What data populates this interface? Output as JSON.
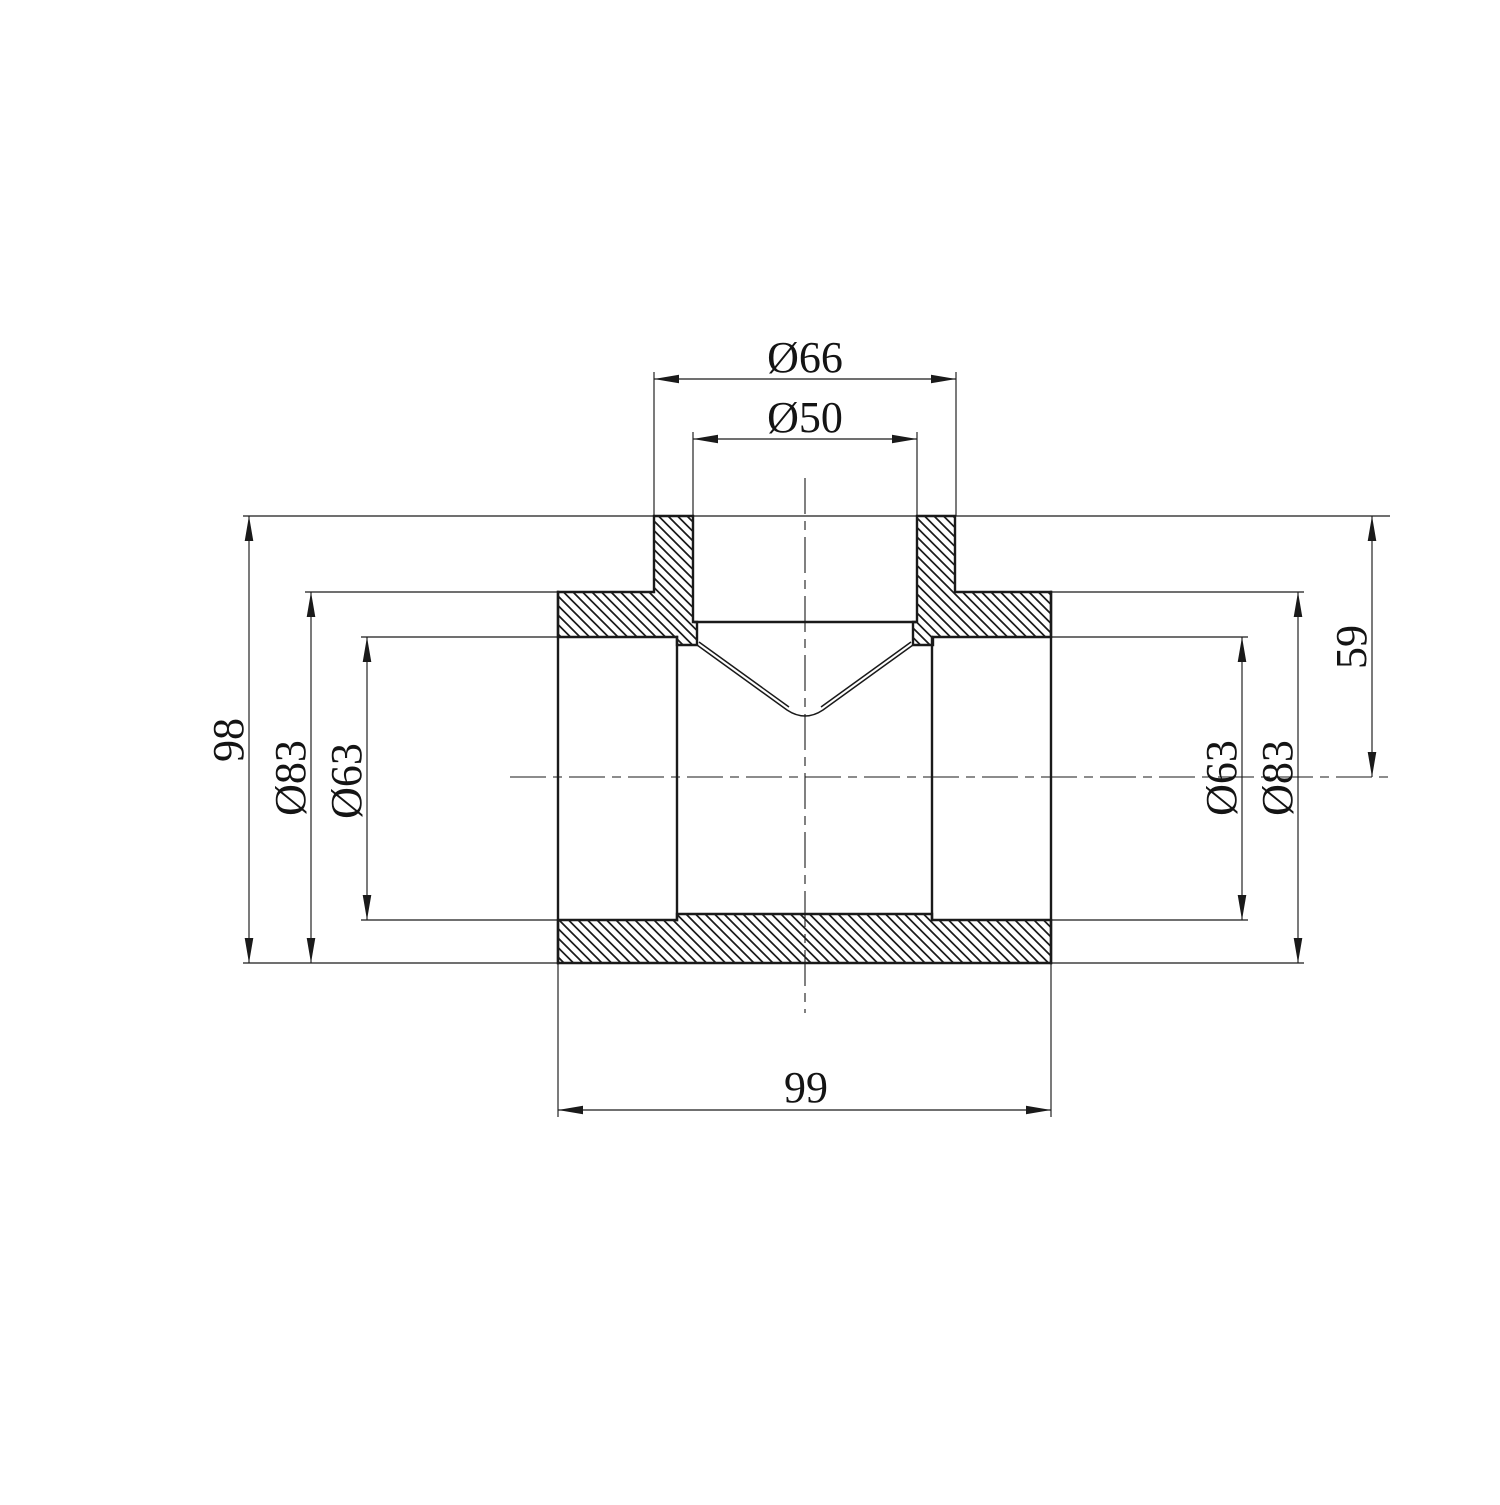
{
  "drawing": {
    "type": "technical-section-drawing",
    "subject": "pipe-tee-fitting-cross-section",
    "colors": {
      "background": "#ffffff",
      "line": "#1a1a1a",
      "text": "#141414"
    },
    "dimensions": {
      "branch_outer_diameter": "Ø66",
      "branch_bore_diameter": "Ø50",
      "overall_height": "98",
      "left_outer_diameter": "Ø83",
      "left_bore_diameter": "Ø63",
      "branch_axis_height": "59",
      "right_bore_diameter": "Ø63",
      "right_outer_diameter": "Ø83",
      "body_length": "99"
    }
  }
}
